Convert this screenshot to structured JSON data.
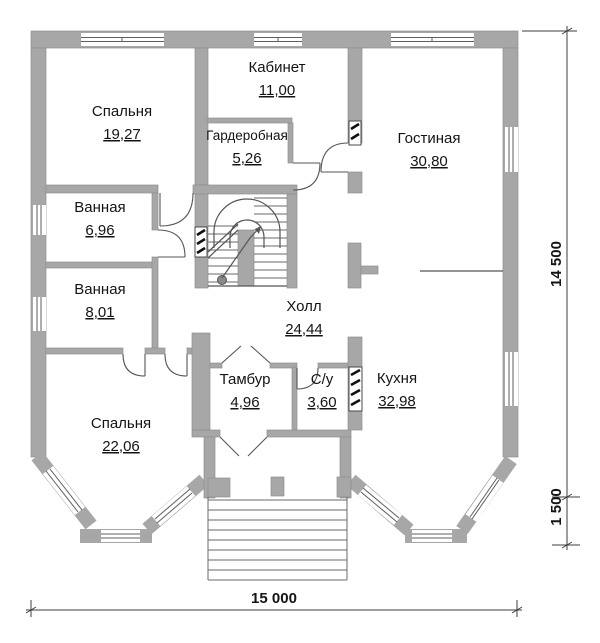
{
  "plan": {
    "type": "floor-plan",
    "rooms": [
      {
        "id": "bedroom-1",
        "name": "Спальня",
        "area": "19,27"
      },
      {
        "id": "office",
        "name": "Кабинет",
        "area": "11,00"
      },
      {
        "id": "wardrobe",
        "name": "Гардеробная",
        "area": "5,26"
      },
      {
        "id": "living-room",
        "name": "Гостиная",
        "area": "30,80"
      },
      {
        "id": "bathroom-1",
        "name": "Ванная",
        "area": "6,96"
      },
      {
        "id": "bathroom-2",
        "name": "Ванная",
        "area": "8,01"
      },
      {
        "id": "hall",
        "name": "Холл",
        "area": "24,44"
      },
      {
        "id": "bedroom-2",
        "name": "Спальня",
        "area": "22,06"
      },
      {
        "id": "vestibule",
        "name": "Тамбур",
        "area": "4,96"
      },
      {
        "id": "wc",
        "name": "С/у",
        "area": "3,60"
      },
      {
        "id": "kitchen",
        "name": "Кухня",
        "area": "32,98"
      }
    ],
    "dimensions": {
      "total_height": "14 500",
      "porch_height": "1 500",
      "total_width": "15 000"
    },
    "colors": {
      "wall": "#a7a7a7",
      "wall_edge": "#8f8f8f",
      "line": "#555555",
      "dimension_line": "#3c3c3c",
      "text": "#141414",
      "background": "#ffffff"
    }
  }
}
